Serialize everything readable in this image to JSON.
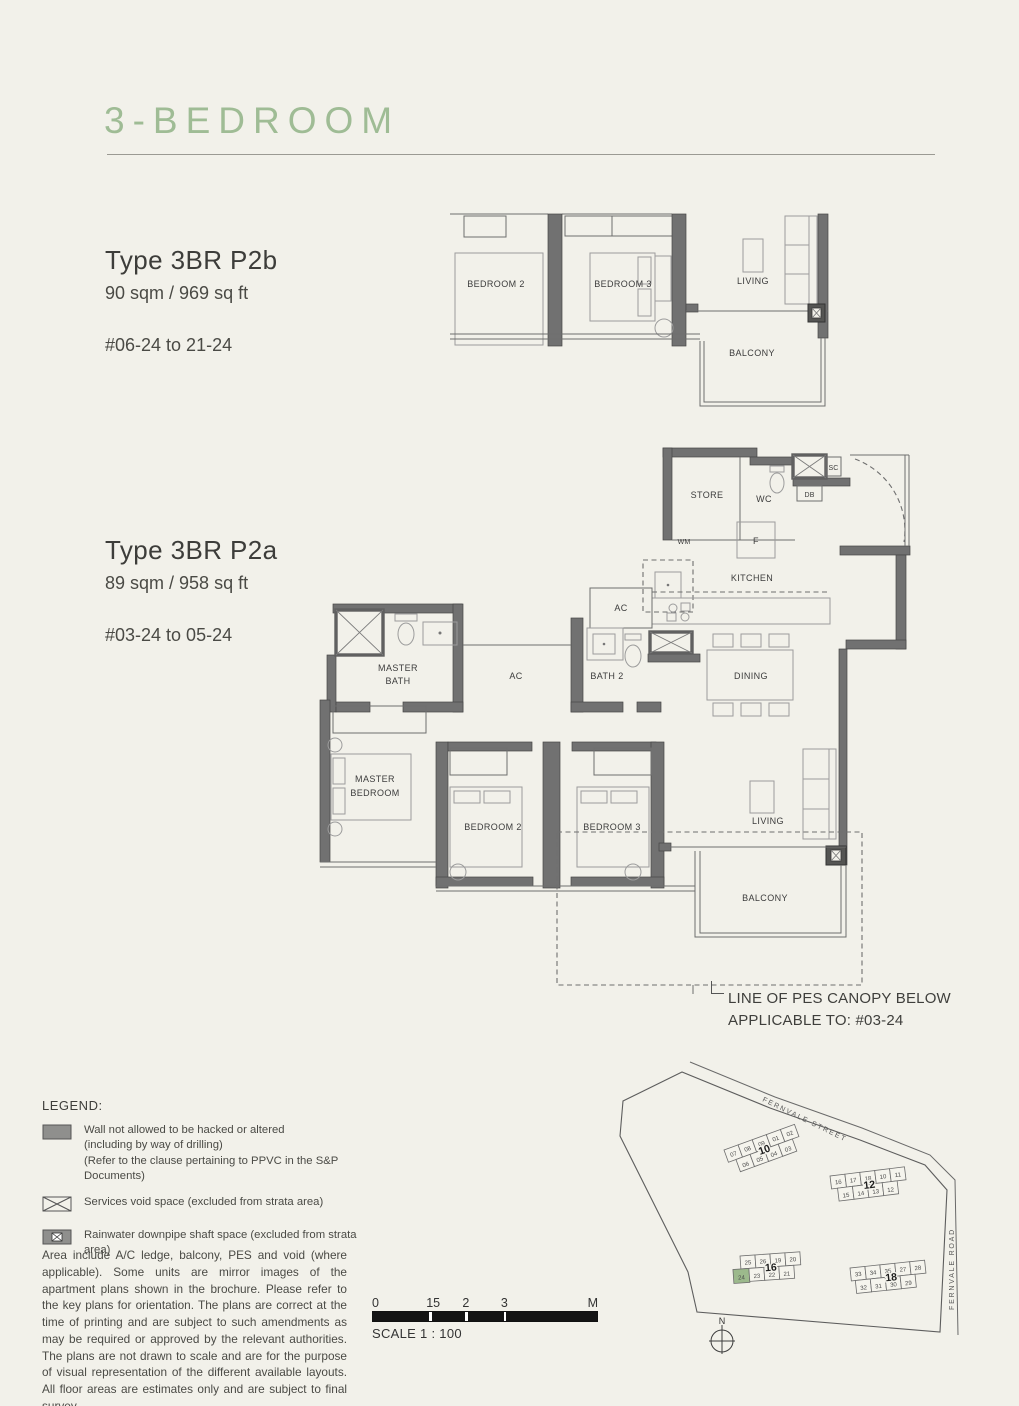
{
  "page": {
    "title": "3-BEDROOM"
  },
  "types": {
    "p2b": {
      "name": "Type 3BR P2b",
      "area": "90 sqm / 969 sq ft",
      "units": "#06-24 to 21-24"
    },
    "p2a": {
      "name": "Type 3BR P2a",
      "area": "89 sqm / 958 sq ft",
      "units": "#03-24 to 05-24"
    }
  },
  "plan_p2b": {
    "labels": {
      "bedroom2": "BEDROOM 2",
      "bedroom3": "BEDROOM 3",
      "living": "LIVING",
      "balcony": "BALCONY"
    }
  },
  "plan_p2a": {
    "labels": {
      "store": "STORE",
      "wc": "WC",
      "sc": "SC",
      "db": "DB",
      "wm": "WM",
      "fridge": "F",
      "kitchen": "KITCHEN",
      "ac_kitchen": "AC",
      "ac_corridor": "AC",
      "master_bath": [
        "MASTER",
        "BATH"
      ],
      "bath2": "BATH 2",
      "dining": "DINING",
      "master_bedroom": [
        "MASTER",
        "BEDROOM"
      ],
      "bedroom2": "BEDROOM 2",
      "bedroom3": "BEDROOM 3",
      "living": "LIVING",
      "balcony": "BALCONY"
    }
  },
  "pes_note": {
    "line1": "LINE OF PES CANOPY BELOW",
    "line2": "APPLICABLE TO: #03-24"
  },
  "legend": {
    "heading": "LEGEND:",
    "wall": {
      "line1": "Wall not allowed to be hacked or altered",
      "line2": "(including by way of drilling)",
      "line3": "(Refer to the clause pertaining to PPVC in the S&P Documents)"
    },
    "services_void": "Services void space (excluded from strata area)",
    "rainwater": "Rainwater downpipe shaft space (excluded from strata area)"
  },
  "disclaimer": "Area include A/C ledge, balcony, PES and void (where applicable). Some units are mirror images of the apartment plans shown in the brochure. Please refer to the key plans for orientation. The plans are correct at the time of printing and are subject to such amendments as may be required or approved by the relevant authorities. The plans are not drawn to scale and are for the purpose of visual representation of the different available layouts. All floor areas are estimates only and are subject to final survey.",
  "scale_bar": {
    "ticks": [
      "0",
      "15",
      "2",
      "3",
      "M"
    ],
    "caption": "SCALE 1 : 100"
  },
  "site_plan": {
    "streets": {
      "street": "FERNVALE STREET",
      "road": "FERNVALE ROAD"
    },
    "north": "N",
    "highlight_unit": "24",
    "colors": {
      "highlight": "#9cb98c"
    },
    "blocks": {
      "b10": {
        "num": "10",
        "top": [
          "07",
          "08",
          "09",
          "01",
          "02"
        ],
        "bottom": [
          "06",
          "05",
          "04",
          "03"
        ]
      },
      "b12": {
        "num": "12",
        "top": [
          "16",
          "17",
          "18",
          "10",
          "11"
        ],
        "bottom": [
          "15",
          "14",
          "13",
          "12"
        ]
      },
      "b16": {
        "num": "16",
        "top": [
          "25",
          "26",
          "19",
          "20"
        ],
        "bottom": [
          "24",
          "23",
          "22",
          "21"
        ]
      },
      "b18": {
        "num": "18",
        "top": [
          "33",
          "34",
          "35",
          "27",
          "28"
        ],
        "bottom": [
          "32",
          "31",
          "30",
          "29"
        ]
      }
    }
  }
}
